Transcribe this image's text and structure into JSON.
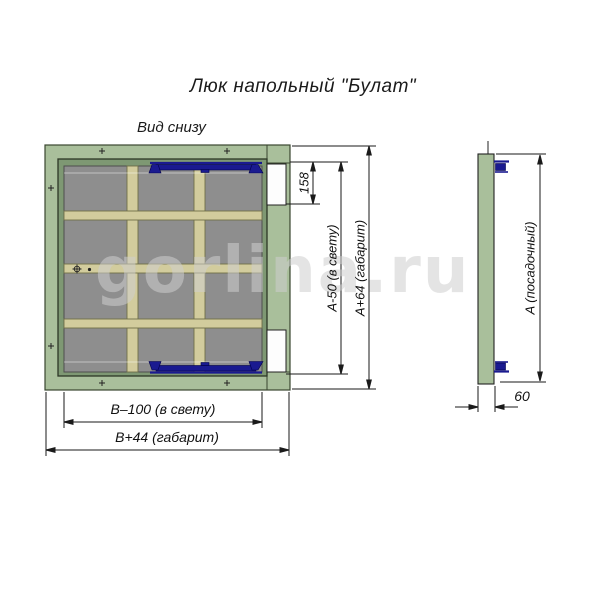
{
  "title": "Люк напольный \"Булат\"",
  "view_label": "Вид снизу",
  "watermark": "gorlina.ru",
  "views": {
    "bottom_view": {
      "label": "Вид снизу",
      "grid_columns": 3,
      "grid_rows": 4,
      "hinges": 2,
      "latch_recesses": 2
    },
    "side_view": {
      "thickness": "60"
    }
  },
  "dimensions": {
    "recess_height": "158",
    "clear_height": "A-50 (в свету)",
    "overall_height": "A+64 (габарит)",
    "clear_width": "B–100 (в свету)",
    "overall_width": "B+44 (габарит)",
    "seat_height": "A (посадочный)",
    "thickness": "60"
  },
  "colors": {
    "frame_green": "#a9bf9b",
    "door_green": "#7e9873",
    "panel_gray": "#8e8e8e",
    "rib_tan": "#d2cc9d",
    "hinge_navy": "#1a1a90",
    "dimension_ink": "#1a1a1a",
    "watermark_gray": "#cdcdcd"
  }
}
